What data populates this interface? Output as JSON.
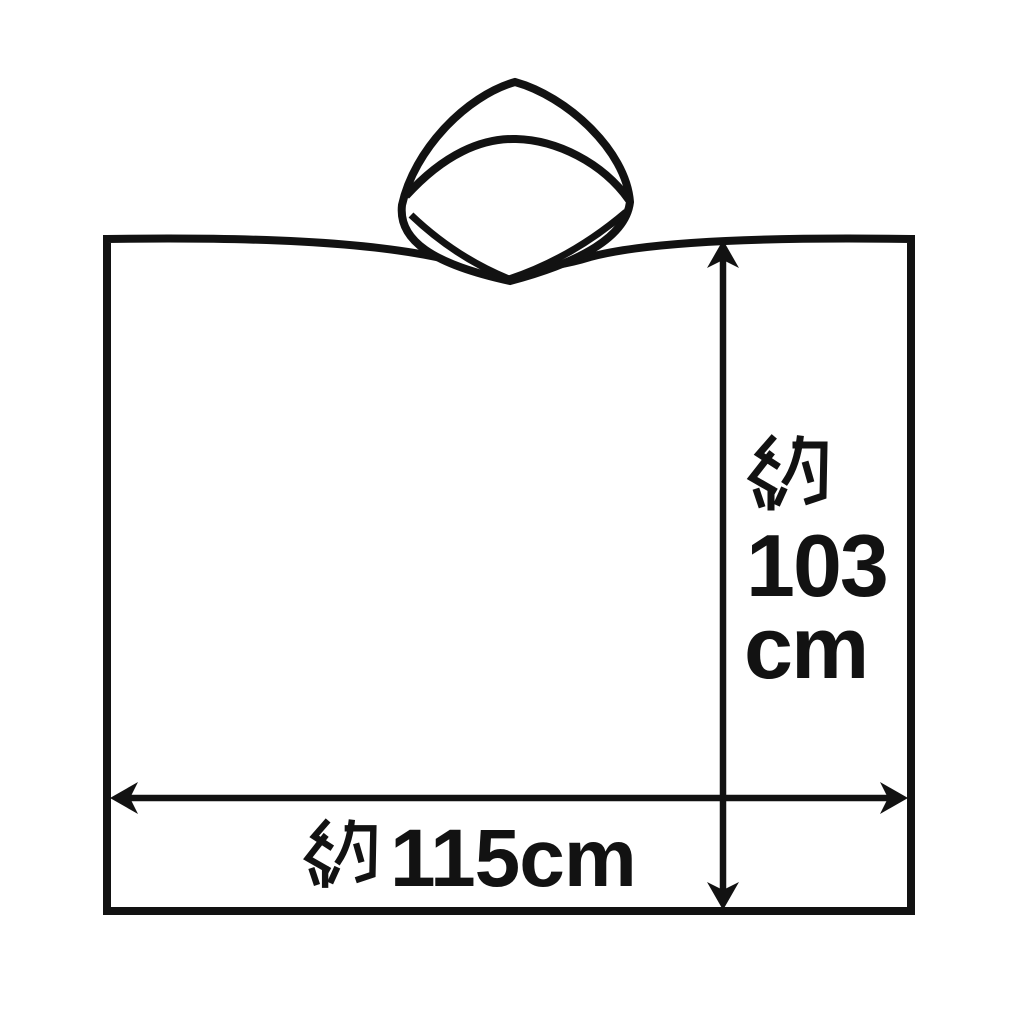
{
  "figure": {
    "background_color": "#ffffff",
    "line_color": "#121212",
    "height_dimension": {
      "full_text": "約103cm",
      "approx_kanji": "約",
      "value": "103",
      "unit": "cm"
    },
    "width_dimension": {
      "full_text": "約115cm",
      "approx_kanji": "約",
      "value_with_unit": "115cm"
    }
  }
}
